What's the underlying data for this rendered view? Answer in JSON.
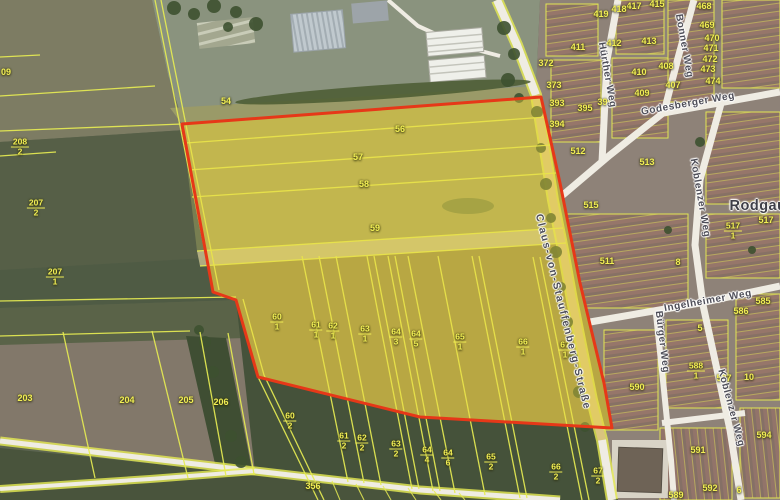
{
  "map": {
    "place_labels": [
      {
        "text": "Rodgau",
        "x": 758,
        "y": 206
      }
    ],
    "street_labels": [
      {
        "text": "Claus-von-Stauffenberg-Straße",
        "x": 563,
        "y": 312,
        "rot": 76,
        "long": true
      },
      {
        "text": "Godesberger Weg",
        "x": 688,
        "y": 104,
        "rot": -10,
        "long": false
      },
      {
        "text": "Hürther Weg",
        "x": 607,
        "y": 75,
        "rot": 80,
        "long": false
      },
      {
        "text": "Bonner Weg",
        "x": 684,
        "y": 46,
        "rot": 80,
        "long": false
      },
      {
        "text": "Koblenzer Weg",
        "x": 700,
        "y": 198,
        "rot": 80,
        "long": false
      },
      {
        "text": "Koblenzer Weg",
        "x": 731,
        "y": 408,
        "rot": 75,
        "long": false
      },
      {
        "text": "Ingelheimer Weg",
        "x": 708,
        "y": 301,
        "rot": -10,
        "long": false
      },
      {
        "text": "Bürger Weg",
        "x": 662,
        "y": 342,
        "rot": 83,
        "long": false
      }
    ],
    "parcel_labels": [
      {
        "text": "09",
        "x": 6,
        "y": 72
      },
      {
        "text": "54",
        "x": 226,
        "y": 101
      },
      {
        "text": "56",
        "x": 400,
        "y": 129
      },
      {
        "text": "57",
        "x": 358,
        "y": 157
      },
      {
        "text": "58",
        "x": 364,
        "y": 184
      },
      {
        "text": "59",
        "x": 375,
        "y": 228
      },
      {
        "text": "203",
        "x": 25,
        "y": 398
      },
      {
        "text": "204",
        "x": 127,
        "y": 400
      },
      {
        "text": "205",
        "x": 186,
        "y": 400
      },
      {
        "text": "206",
        "x": 221,
        "y": 402
      },
      {
        "text": "356",
        "x": 313,
        "y": 486
      },
      {
        "text": "372",
        "x": 546,
        "y": 63
      },
      {
        "text": "373",
        "x": 554,
        "y": 85
      },
      {
        "text": "393",
        "x": 557,
        "y": 103
      },
      {
        "text": "394",
        "x": 557,
        "y": 124
      },
      {
        "text": "395",
        "x": 585,
        "y": 108
      },
      {
        "text": "396",
        "x": 605,
        "y": 102
      },
      {
        "text": "407",
        "x": 673,
        "y": 85
      },
      {
        "text": "408",
        "x": 666,
        "y": 66
      },
      {
        "text": "409",
        "x": 642,
        "y": 93
      },
      {
        "text": "410",
        "x": 639,
        "y": 72
      },
      {
        "text": "411",
        "x": 578,
        "y": 47
      },
      {
        "text": "412",
        "x": 614,
        "y": 43
      },
      {
        "text": "413",
        "x": 649,
        "y": 41
      },
      {
        "text": "415",
        "x": 657,
        "y": 4
      },
      {
        "text": "417",
        "x": 634,
        "y": 6
      },
      {
        "text": "418",
        "x": 619,
        "y": 9
      },
      {
        "text": "419",
        "x": 601,
        "y": 14
      },
      {
        "text": "468",
        "x": 704,
        "y": 6
      },
      {
        "text": "469",
        "x": 707,
        "y": 25
      },
      {
        "text": "470",
        "x": 712,
        "y": 38
      },
      {
        "text": "471",
        "x": 711,
        "y": 48
      },
      {
        "text": "472",
        "x": 710,
        "y": 59
      },
      {
        "text": "473",
        "x": 708,
        "y": 69
      },
      {
        "text": "474",
        "x": 713,
        "y": 81
      },
      {
        "text": "511",
        "x": 607,
        "y": 261
      },
      {
        "text": "512",
        "x": 578,
        "y": 151
      },
      {
        "text": "513",
        "x": 647,
        "y": 162
      },
      {
        "text": "515",
        "x": 591,
        "y": 205
      },
      {
        "text": "517",
        "x": 766,
        "y": 220
      },
      {
        "text": "585",
        "x": 763,
        "y": 301
      },
      {
        "text": "586",
        "x": 741,
        "y": 311
      },
      {
        "text": "587",
        "x": 724,
        "y": 378
      },
      {
        "text": "590",
        "x": 637,
        "y": 387
      },
      {
        "text": "591",
        "x": 698,
        "y": 450
      },
      {
        "text": "592",
        "x": 710,
        "y": 488
      },
      {
        "text": "589",
        "x": 676,
        "y": 495
      },
      {
        "text": "594",
        "x": 764,
        "y": 435
      },
      {
        "text": "5",
        "x": 700,
        "y": 328
      },
      {
        "text": "8",
        "x": 678,
        "y": 262
      },
      {
        "text": "10",
        "x": 749,
        "y": 377
      },
      {
        "text": "6",
        "x": 739,
        "y": 490
      }
    ],
    "parcel_fractions": [
      {
        "n": "208",
        "d": "2",
        "x": 20,
        "y": 147
      },
      {
        "n": "207",
        "d": "2",
        "x": 36,
        "y": 208
      },
      {
        "n": "207",
        "d": "1",
        "x": 55,
        "y": 277
      },
      {
        "n": "60",
        "d": "1",
        "x": 277,
        "y": 322
      },
      {
        "n": "61",
        "d": "1",
        "x": 316,
        "y": 330
      },
      {
        "n": "62",
        "d": "1",
        "x": 333,
        "y": 331
      },
      {
        "n": "63",
        "d": "1",
        "x": 365,
        "y": 334
      },
      {
        "n": "64",
        "d": "3",
        "x": 396,
        "y": 337
      },
      {
        "n": "64",
        "d": "5",
        "x": 416,
        "y": 339
      },
      {
        "n": "65",
        "d": "1",
        "x": 460,
        "y": 342
      },
      {
        "n": "66",
        "d": "1",
        "x": 523,
        "y": 347
      },
      {
        "n": "67",
        "d": "1",
        "x": 565,
        "y": 350
      },
      {
        "n": "60",
        "d": "2",
        "x": 290,
        "y": 421
      },
      {
        "n": "61",
        "d": "2",
        "x": 344,
        "y": 441
      },
      {
        "n": "62",
        "d": "2",
        "x": 362,
        "y": 443
      },
      {
        "n": "63",
        "d": "2",
        "x": 396,
        "y": 449
      },
      {
        "n": "64",
        "d": "4",
        "x": 427,
        "y": 455
      },
      {
        "n": "64",
        "d": "6",
        "x": 448,
        "y": 458
      },
      {
        "n": "65",
        "d": "2",
        "x": 491,
        "y": 462
      },
      {
        "n": "66",
        "d": "2",
        "x": 556,
        "y": 472
      },
      {
        "n": "67",
        "d": "2",
        "x": 598,
        "y": 476
      },
      {
        "n": "517",
        "d": "1",
        "x": 733,
        "y": 231
      },
      {
        "n": "588",
        "d": "1",
        "x": 696,
        "y": 371
      }
    ],
    "colors": {
      "boundary_red": "#e63818",
      "cadastral_yellow": "#e6eb52",
      "highlight_fill": "rgba(238,216,60,0.38)",
      "label_yellow": "#f2ef55",
      "road_white": "#efece3",
      "street_label": "#4e4e58"
    }
  }
}
